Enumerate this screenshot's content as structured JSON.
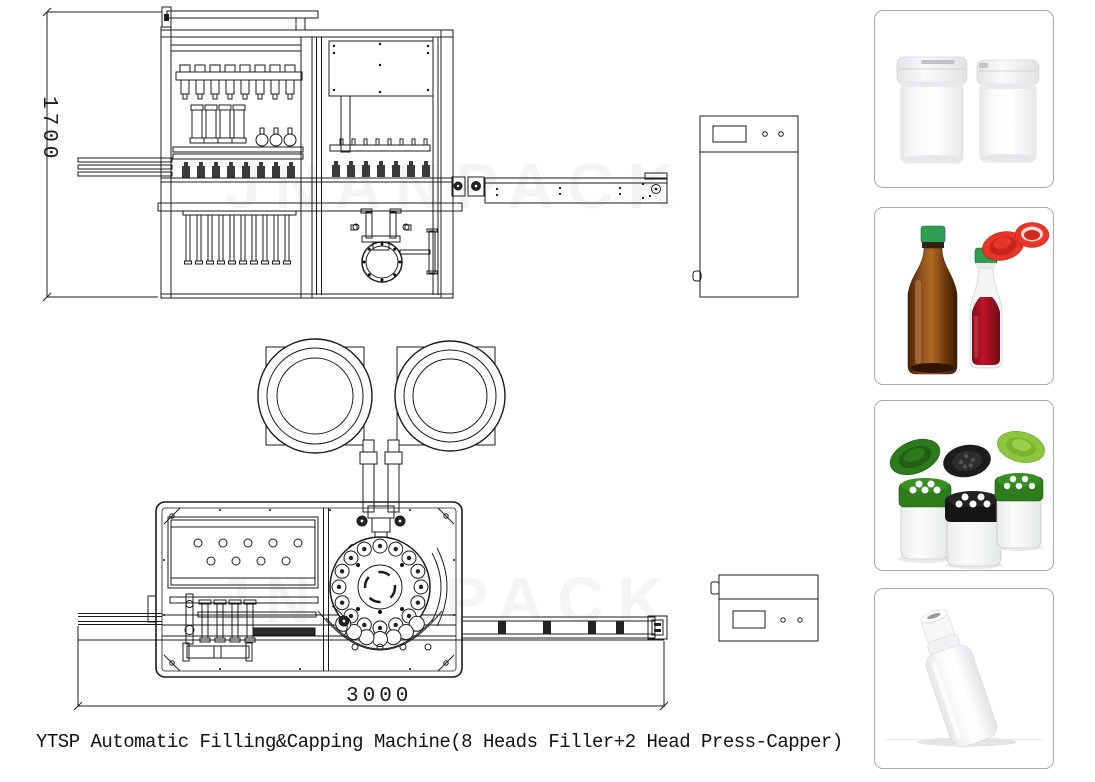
{
  "page": {
    "width": 1095,
    "height": 782,
    "background": "#ffffff"
  },
  "caption": {
    "text": "YTSP Automatic Filling&Capping Machine(8 Heads Filler+2 Head Press-Capper)"
  },
  "drawing": {
    "watermark": "JNANPACK",
    "side_view": {
      "label": "side-elevation-view",
      "height_dimension": "1700"
    },
    "plan_view": {
      "label": "top-plan-view",
      "length_dimension": "3000"
    }
  },
  "products": [
    {
      "name": "white-plastic-jars"
    },
    {
      "name": "sauce-bottles-with-red-caps"
    },
    {
      "name": "spice-shaker-jars"
    },
    {
      "name": "white-lotion-bottle"
    }
  ],
  "colors": {
    "line": "#1b1b1b",
    "card_border": "#a8a8a8",
    "green_cap": "#2f9e52",
    "amber_glass": "#8a4a12",
    "red_cap": "#e8352b",
    "red_liquid": "#9c1322",
    "dark_green_cap": "#2e7d1c",
    "light_green_cap": "#8cc63e",
    "black_cap": "#1b1b1b"
  }
}
